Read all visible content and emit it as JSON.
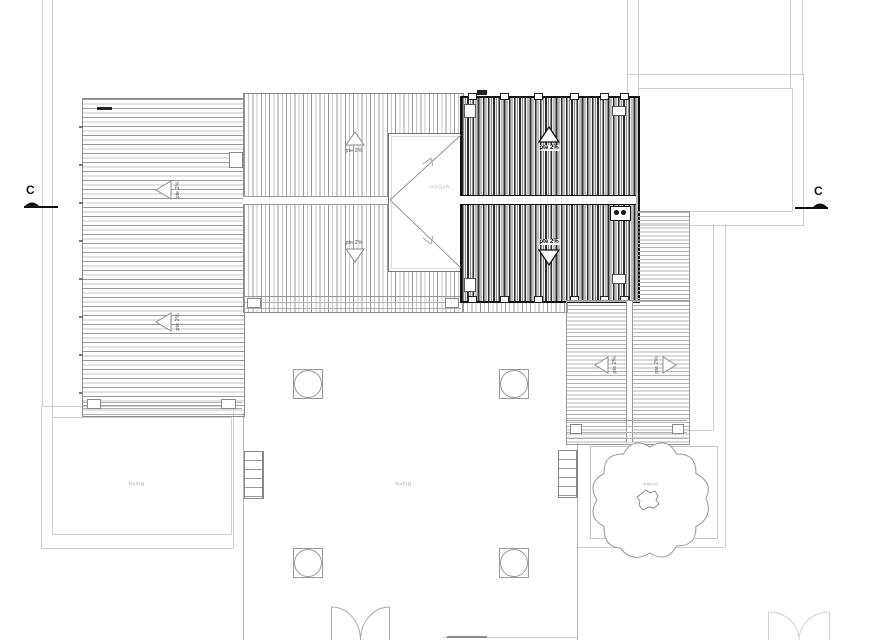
{
  "labels": {
    "slope": "pte 2%",
    "patio": "PATIO",
    "hip": "HOGAR"
  },
  "markers": {
    "section_left": "C",
    "section_right": "C"
  },
  "colors": {
    "paper": "#ffffff",
    "faint_outline": "#cfcfcf",
    "hatch_light": "#b3b3b3",
    "hatch_medium": "#9a9a9a",
    "roof_dark": "#2e2e2e",
    "marker_dark": "#111111"
  }
}
